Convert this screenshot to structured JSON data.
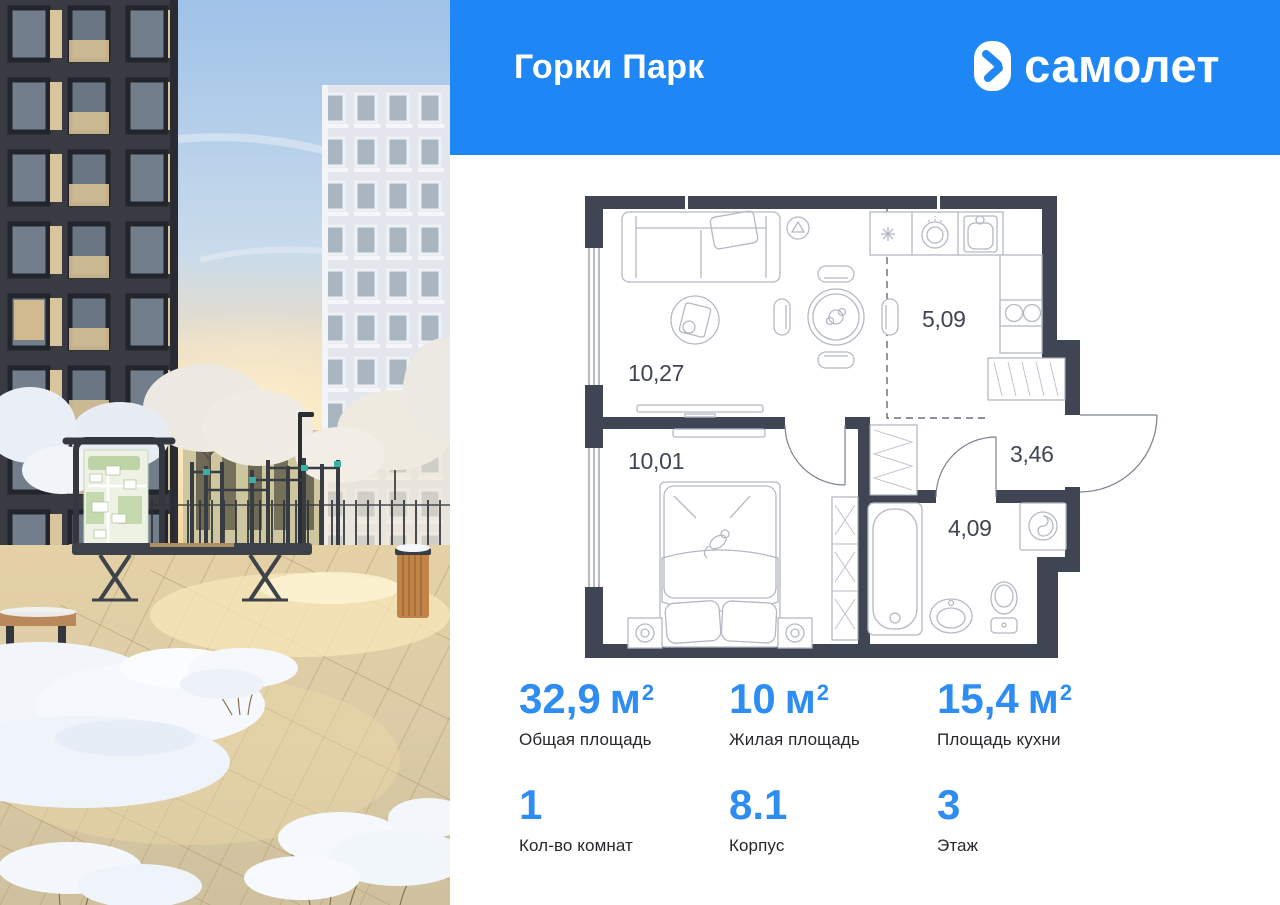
{
  "theme": {
    "accent_blue": "#1E87F5",
    "stat_value_blue": "#2E8DF2",
    "label_color": "#26282C",
    "wall_color": "#3F4552",
    "furniture_line_color": "#B4B9C4",
    "door_color": "#7B828E",
    "dash_color": "#4A5160",
    "room_label_color": "#3F4552"
  },
  "header": {
    "project_name": "Горки Парк",
    "brand_name": "самолет",
    "logo_icon": "samolet-arrow-icon"
  },
  "floor_plan": {
    "rooms": [
      {
        "room": "living-room",
        "area": "10,27"
      },
      {
        "room": "kitchen",
        "area": "5,09"
      },
      {
        "room": "hallway",
        "area": "3,46"
      },
      {
        "room": "bedroom",
        "area": "10,01"
      },
      {
        "room": "bathroom",
        "area": "4,09"
      }
    ]
  },
  "stats": {
    "row1": [
      {
        "value": "32,9",
        "unit": "м",
        "sup": "2",
        "label": "Общая площадь"
      },
      {
        "value": "10",
        "unit": "м",
        "sup": "2",
        "label": "Жилая площадь"
      },
      {
        "value": "15,4",
        "unit": "м",
        "sup": "2",
        "label": "Площадь кухни"
      }
    ],
    "row2": [
      {
        "value": "1",
        "unit": "",
        "sup": "",
        "label": "Кол-во комнат"
      },
      {
        "value": "8.1",
        "unit": "",
        "sup": "",
        "label": "Корпус"
      },
      {
        "value": "3",
        "unit": "",
        "sup": "",
        "label": "Этаж"
      }
    ]
  }
}
